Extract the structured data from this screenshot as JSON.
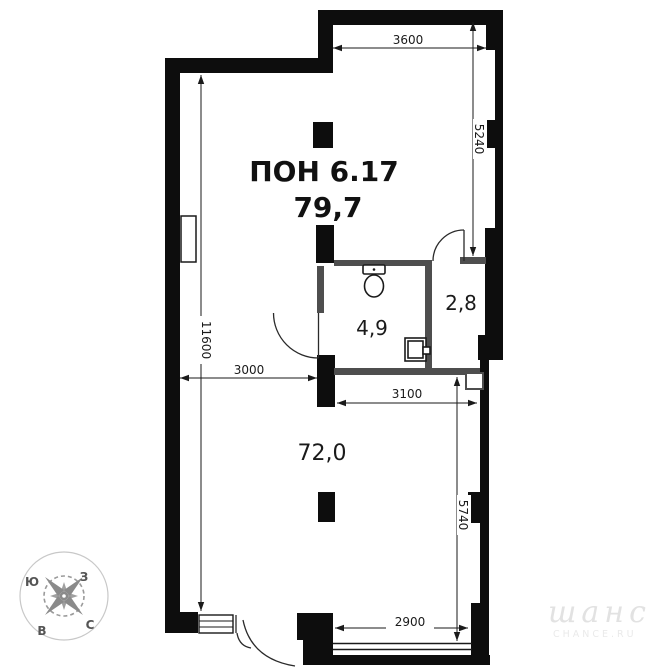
{
  "plan": {
    "title": "ПОН 6.17",
    "total_area": "79,7",
    "rooms": [
      {
        "name": "bathroom",
        "area": "4,9"
      },
      {
        "name": "storage",
        "area": "2,8"
      },
      {
        "name": "main-hall",
        "area": "72,0"
      }
    ],
    "dimensions": {
      "top_width": "3600",
      "right_upper_height": "5240",
      "left_height": "11600",
      "mid_left_width": "3000",
      "mid_right_width": "3100",
      "right_lower_height": "5740",
      "bottom_window_width": "2900"
    },
    "compass": {
      "south": "Ю",
      "west": "З",
      "east": "В",
      "north": "С"
    },
    "watermark": {
      "script": "шанс",
      "caption": "CHANCE.RU"
    },
    "colors": {
      "wall": "#0d0d0d",
      "partition": "#4e4e4e",
      "dimension": "#1a1a1a",
      "compass": "#8a8a8a",
      "watermark": "#e2e2e2"
    }
  }
}
